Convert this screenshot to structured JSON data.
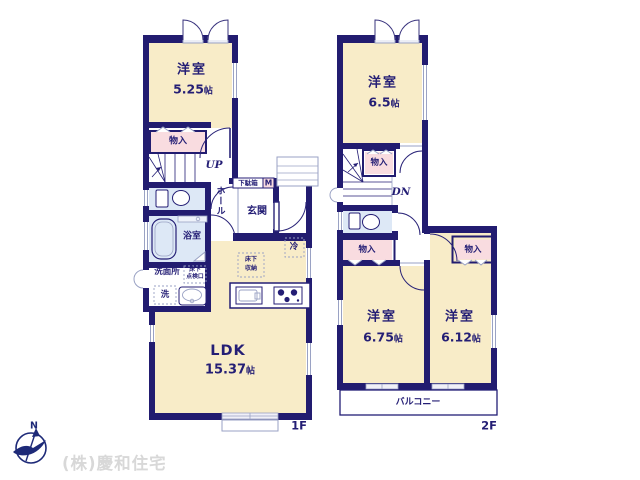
{
  "colors": {
    "wall": "#221c70",
    "room_fill": "#f8ecc8",
    "closet_fill": "#f9dce0",
    "wet_fill": "#dde8f6",
    "fixture_line": "#9aa2c4",
    "text": "#241e75",
    "watermark": "#d8d8d8"
  },
  "f1": {
    "label": "1F",
    "yoshitsu": {
      "name": "洋室",
      "num": "5.25",
      "unit": "帖"
    },
    "closet": "物入",
    "up": "UP",
    "hall": "ホール",
    "shoebox": "下駄箱",
    "shoebox_m": "M",
    "genkan": "玄関",
    "bath": "浴室",
    "washroom": "洗面所",
    "washer": "洗",
    "inspect_l1": "床下",
    "inspect_l2": "点検口",
    "fridge": "冷",
    "ufs_l1": "床下",
    "ufs_l2": "収納",
    "ldk": {
      "name": "LDK",
      "num": "15.37",
      "unit": "帖"
    }
  },
  "f2": {
    "label": "2F",
    "r65": {
      "name": "洋室",
      "num": "6.5",
      "unit": "帖"
    },
    "closet_top": "物入",
    "dn": "DN",
    "closet_left": "物入",
    "closet_right": "物入",
    "r675": {
      "name": "洋室",
      "num": "6.75",
      "unit": "帖"
    },
    "r612": {
      "name": "洋室",
      "num": "6.12",
      "unit": "帖"
    },
    "balcony": "バルコニー"
  },
  "footer": {
    "north": "N",
    "company": "(株)慶和住宅"
  }
}
